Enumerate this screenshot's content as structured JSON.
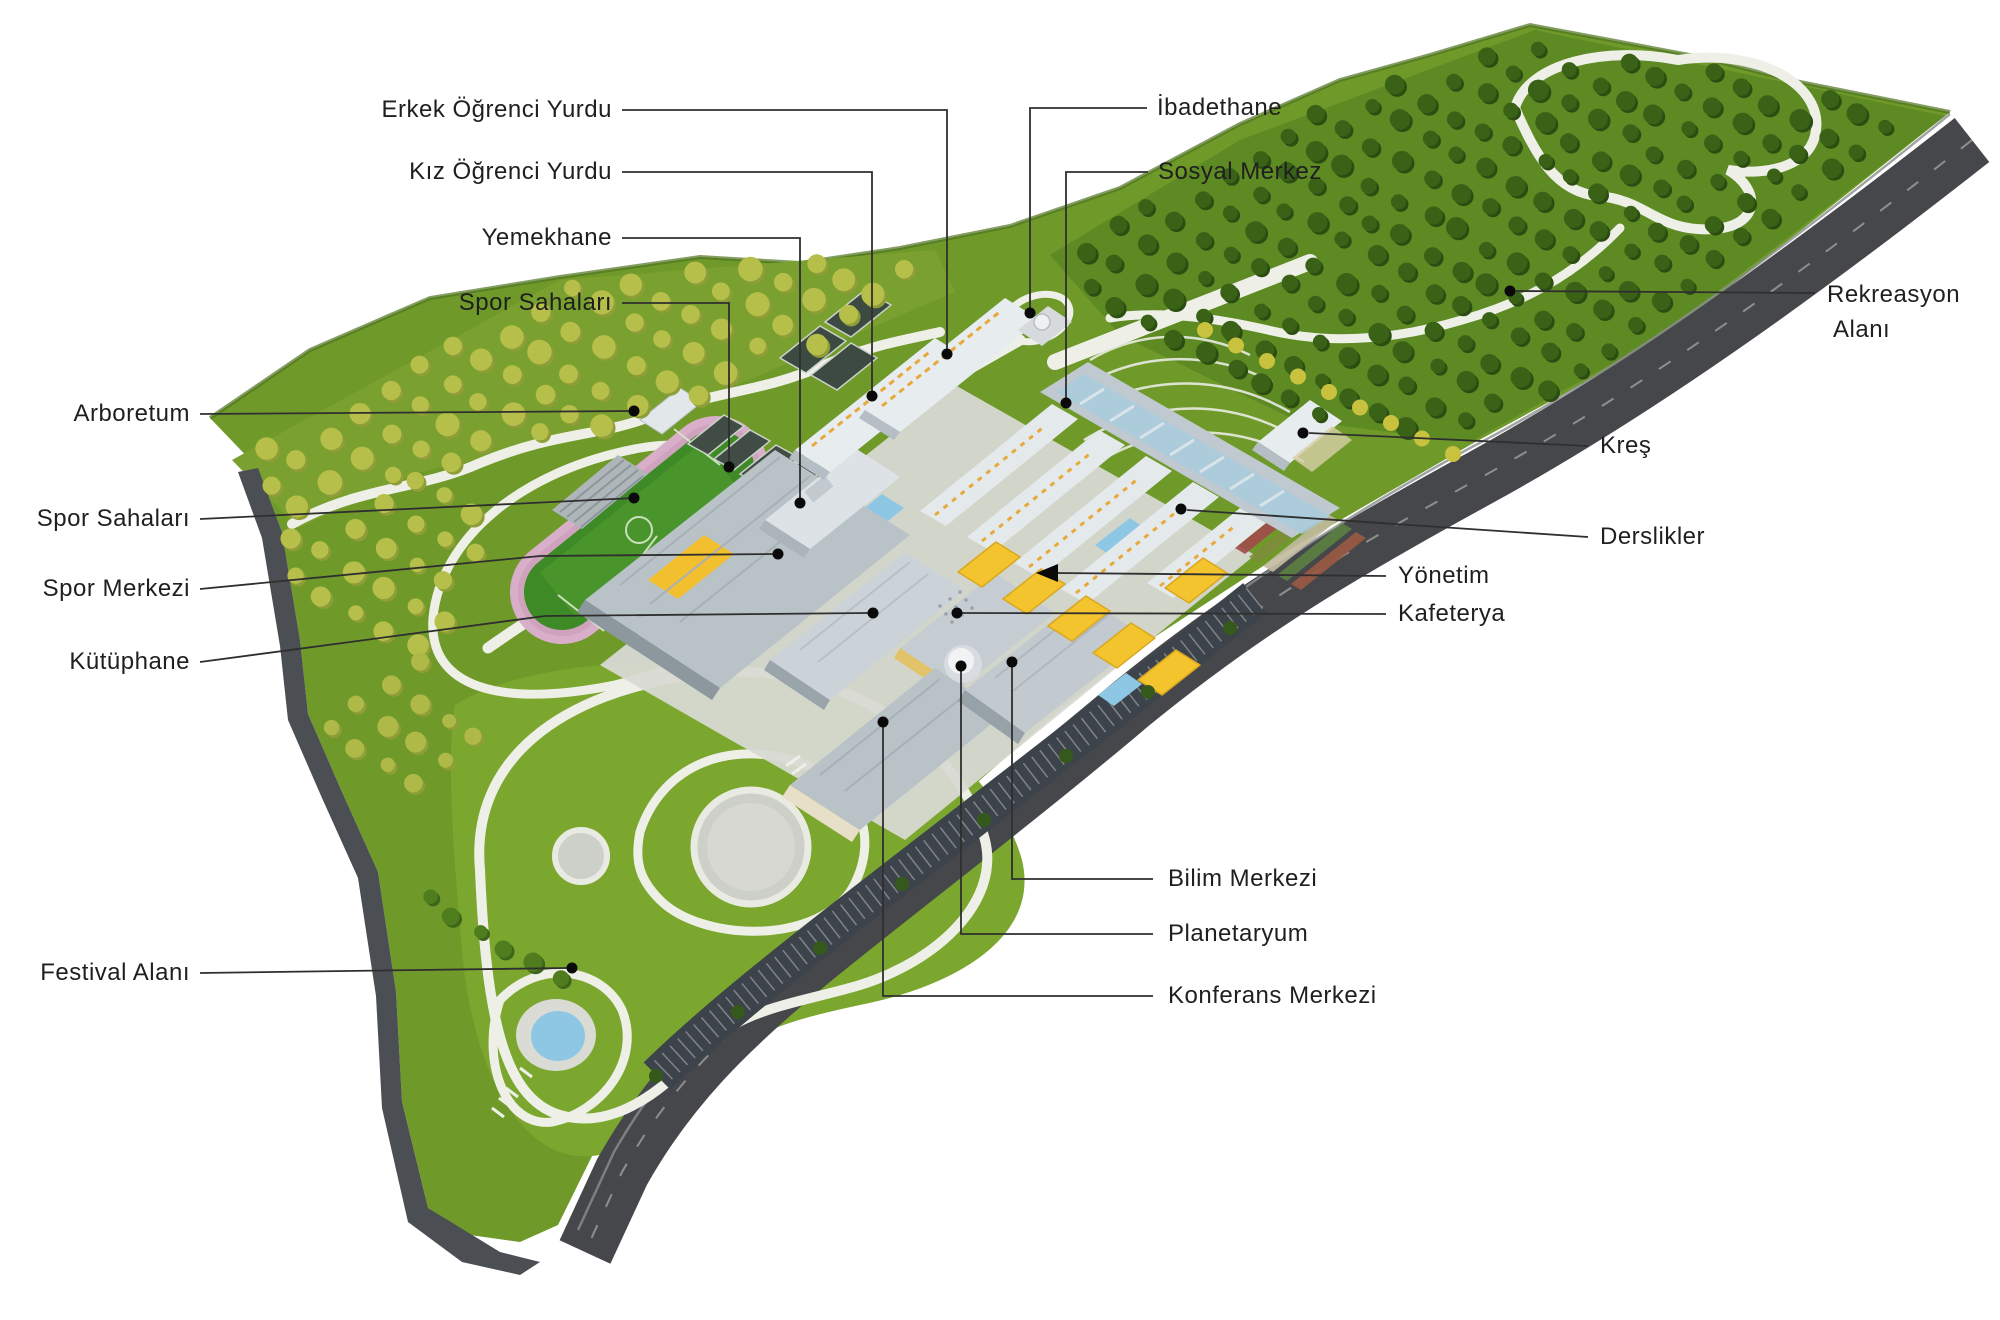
{
  "diagram_language": "Turkish",
  "annotations": [
    {
      "id": "erkek-ogrenci-yurdu",
      "label": "Erkek Öğrenci Yurdu"
    },
    {
      "id": "kiz-ogrenci-yurdu",
      "label": "Kız Öğrenci Yurdu"
    },
    {
      "id": "yemekhane",
      "label": "Yemekhane"
    },
    {
      "id": "spor-sahalari-ust",
      "label": "Spor Sahaları"
    },
    {
      "id": "arboretum",
      "label": "Arboretum"
    },
    {
      "id": "spor-sahalari-sol",
      "label": "Spor Sahaları"
    },
    {
      "id": "spor-merkezi",
      "label": "Spor Merkezi"
    },
    {
      "id": "kutuphane",
      "label": "Kütüphane"
    },
    {
      "id": "festival-alani",
      "label": "Festival Alanı"
    },
    {
      "id": "ibadethane",
      "label": "İbadethane"
    },
    {
      "id": "sosyal-merkez",
      "label": "Sosyal Merkez"
    },
    {
      "id": "rekreasyon-alani",
      "label": "Rekreasyon Alanı",
      "lines": [
        "Rekreasyon",
        "Alanı"
      ]
    },
    {
      "id": "kres",
      "label": "Kreş"
    },
    {
      "id": "derslikler",
      "label": "Derslikler"
    },
    {
      "id": "yonetim",
      "label": "Yönetim"
    },
    {
      "id": "kafeterya",
      "label": "Kafeterya"
    },
    {
      "id": "bilim-merkezi",
      "label": "Bilim Merkezi"
    },
    {
      "id": "planetaryum",
      "label": "Planetaryum"
    },
    {
      "id": "konferans-merkezi",
      "label": "Konferans Merkezi"
    }
  ],
  "colors": {
    "background": "#ffffff",
    "grass": "#6f9a2a",
    "orchard_grass": "#7aa02f",
    "recreation_grass": "#5d8a22",
    "festival_lawn": "#7ca72e",
    "road": "#45474b",
    "retaining_wall": "#4b4e52",
    "path_white": "#eef0e8",
    "track_pink": "#d9aec9",
    "pitch_green": "#3e8a26",
    "roof_gray": "#ccd3d8",
    "building_white": "#e7ecef",
    "glass_blue": "#a9cddd",
    "canopy_yellow": "#f4c42f",
    "pool_blue": "#8ec7e4",
    "orchard_tree": "#b5bf4a",
    "dark_tree": "#3a6217",
    "label_text": "#1f1f1f",
    "leader_line": "#2f2f2f"
  }
}
